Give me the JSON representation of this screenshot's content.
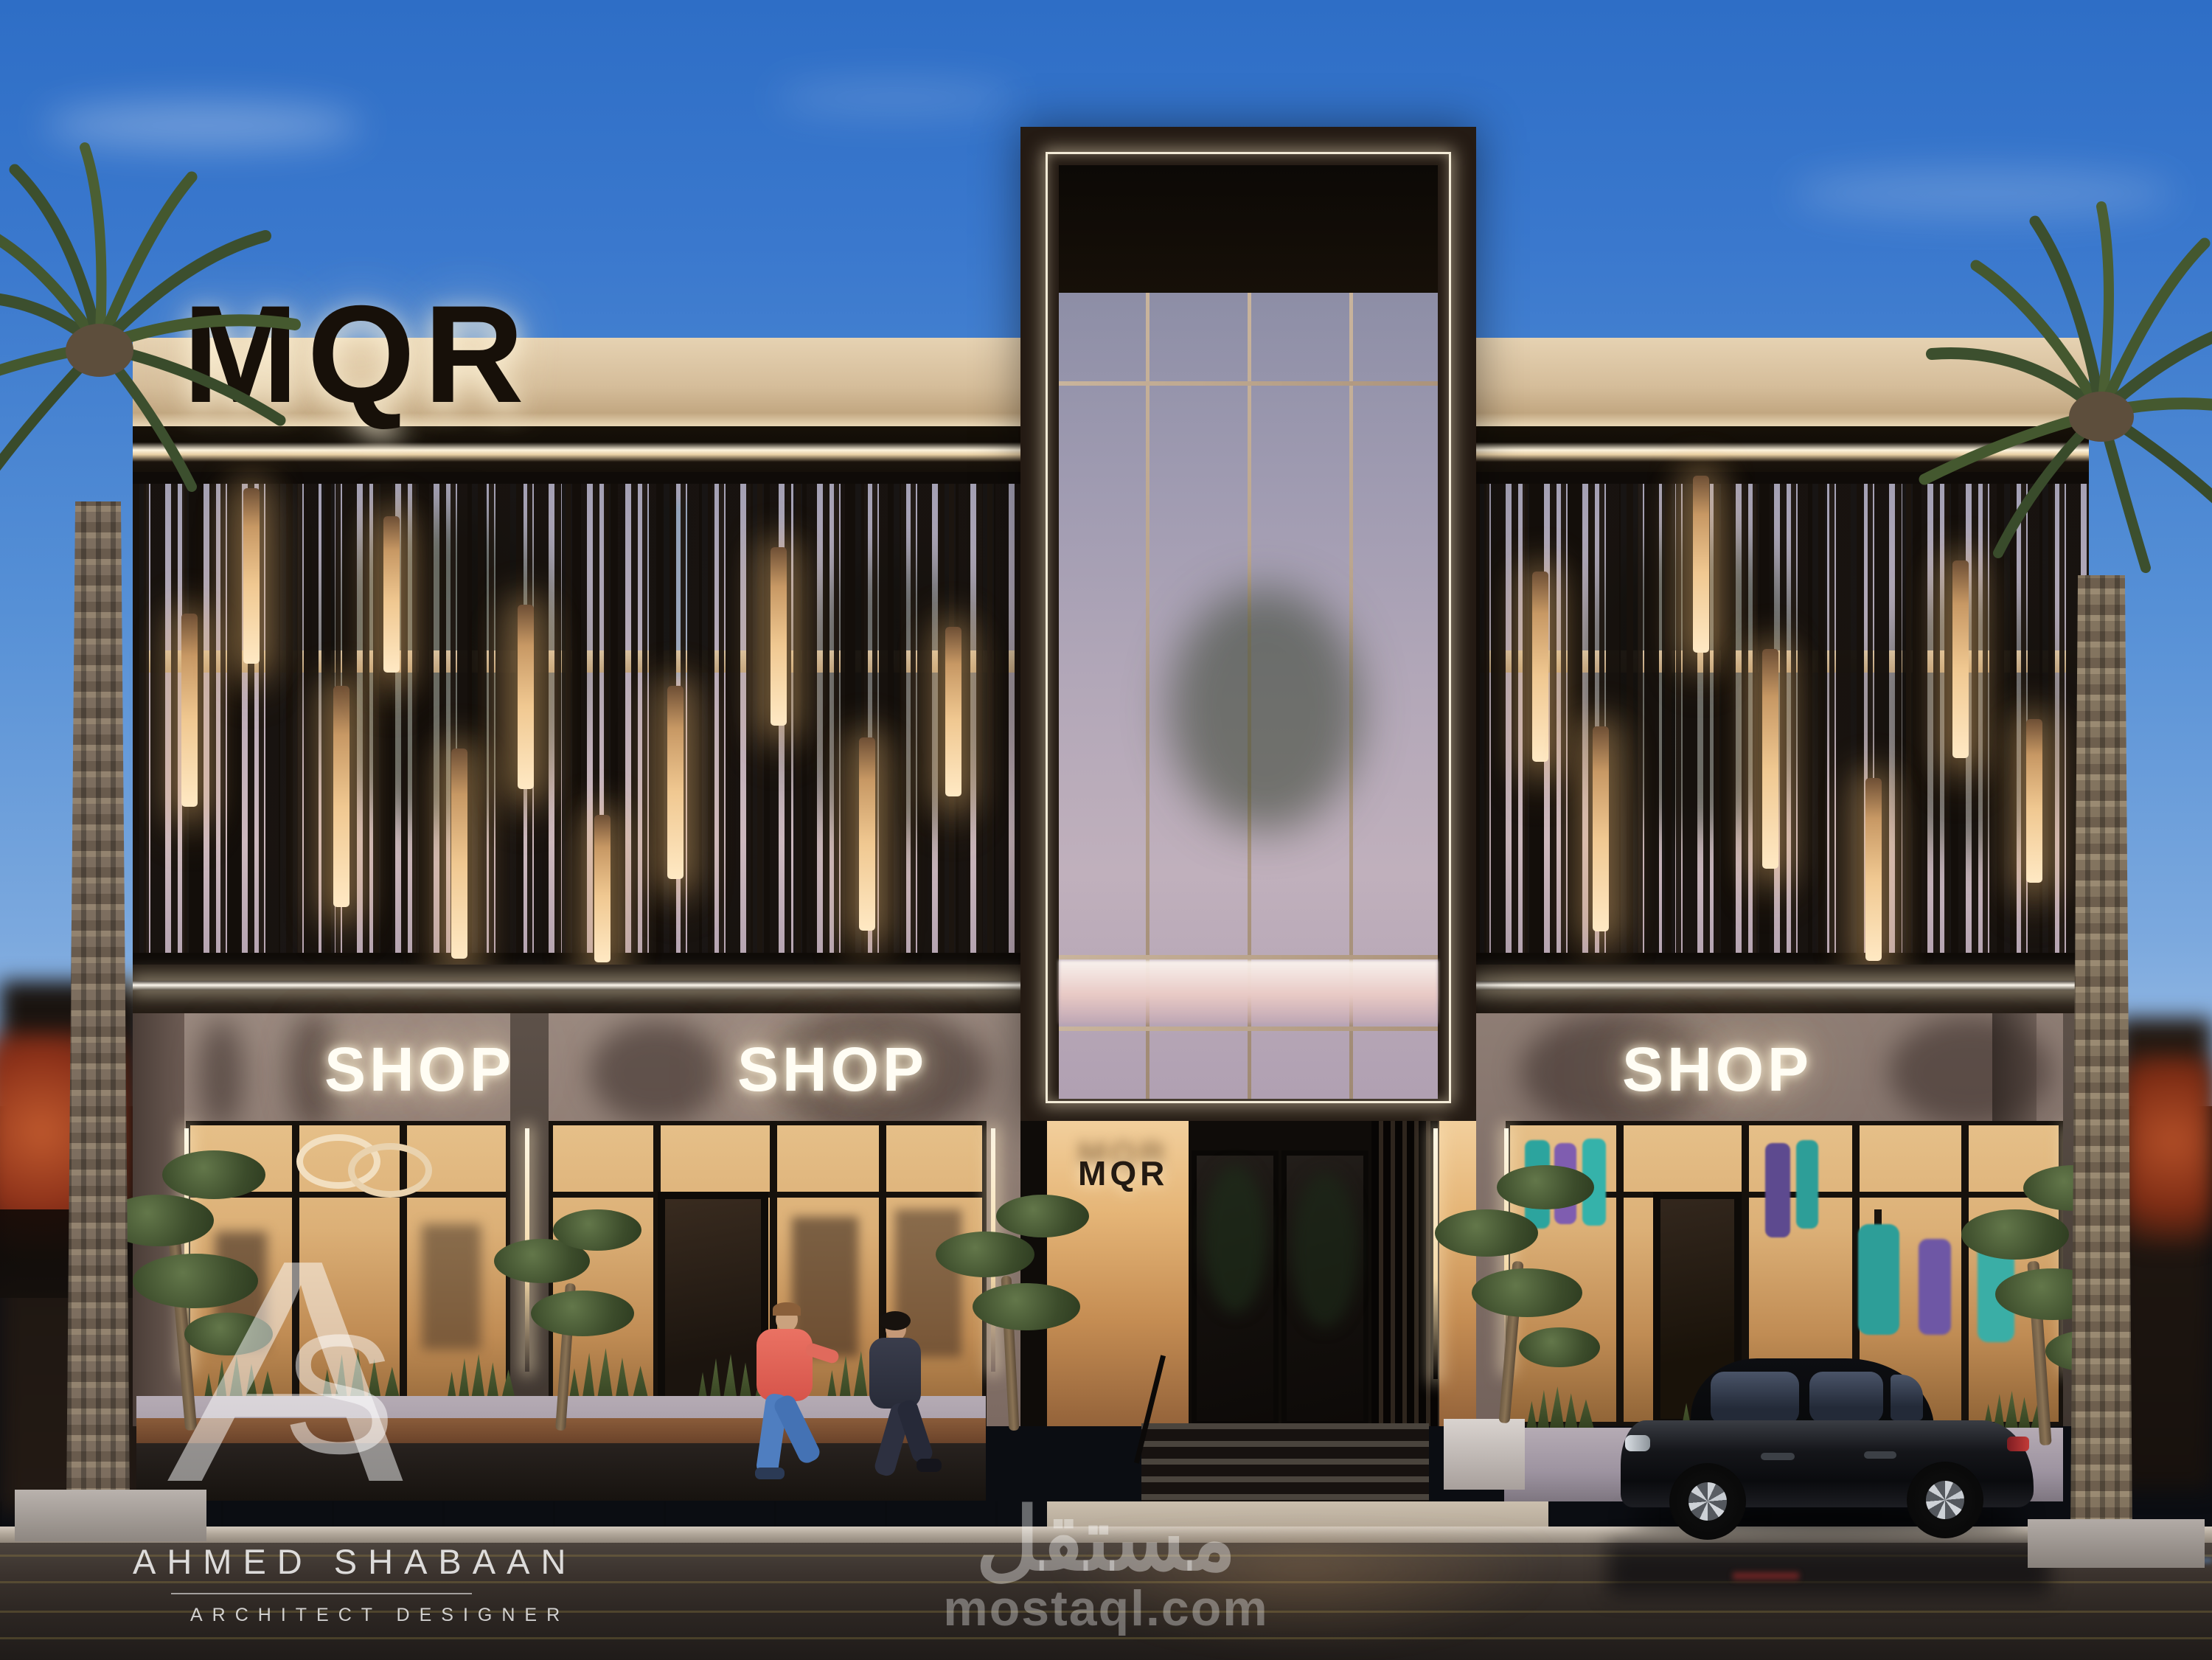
{
  "scene": {
    "description": "Dusk exterior rendering of MQR two-storey retail building with slatted second-floor screen, central glass tower entrance, three lit SHOP storefronts, palm trees, wet street and parked black sedan"
  },
  "signage": {
    "roof_logo": "MQR",
    "entrance_logo": "MQR",
    "shop_signs": [
      "SHOP",
      "SHOP",
      "SHOP"
    ]
  },
  "watermark": {
    "monogram_a": "A",
    "monogram_s": "S",
    "designer_name": "AHMED SHABAAN",
    "designer_title": "ARCHITECT DESIGNER",
    "platform_name_ar": "مستقل",
    "platform_domain": "mostaql.com"
  },
  "palette": {
    "sky_top": "#2e6ec6",
    "sky_horizon": "#9dbfe6",
    "parapet_cream": "#d5bd9a",
    "facade_dark": "#1c1510",
    "warm_lamp": "#f0c891",
    "fascia_taupe": "#8d7a72",
    "neon_white": "#fffdf4",
    "storefront_glow": "#dcb077",
    "road_asphalt": "#2d2723"
  }
}
